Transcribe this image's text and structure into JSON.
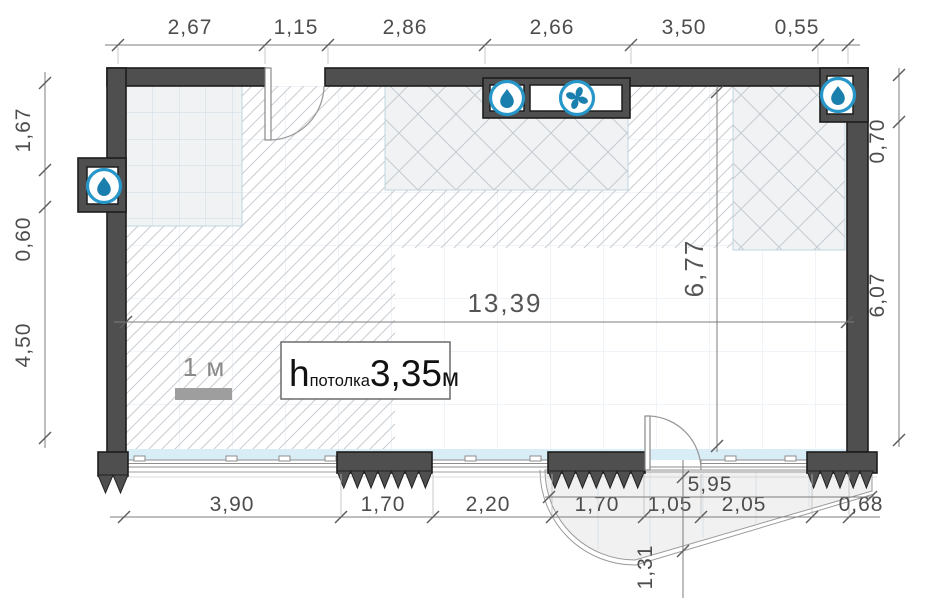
{
  "plan": {
    "scale_label": "1 м",
    "ceiling": {
      "symbol": "h",
      "subscript": "потолка",
      "value": "3,35",
      "unit": "м"
    },
    "dimensions": {
      "top": [
        "2,67",
        "1,15",
        "2,86",
        "2,66",
        "3,50",
        "0,55"
      ],
      "left": [
        "1,67",
        "0,60",
        "4,50"
      ],
      "right": [
        "0,70",
        "6,07"
      ],
      "bottom": [
        "3,90",
        "1,70",
        "2,20",
        "1,70",
        "1,05",
        "2,05",
        "0,68"
      ],
      "interior_width": "13,39",
      "interior_height": "6,77",
      "balcony_width": "5,95",
      "balcony_depth": "1,31"
    },
    "icons": {
      "left_wall": "water-drop-icon",
      "top_niche_1": "water-drop-icon",
      "top_niche_2": "fan-icon",
      "right_wall": "water-drop-icon"
    },
    "colors": {
      "wall": "#4f4f4f",
      "accent_blue": "#2796c8",
      "glyph_blue": "#1b7fae",
      "window_band": "#d9edf6",
      "hatch": "#c9cdd1",
      "dim_text": "#4d4d4d"
    }
  }
}
